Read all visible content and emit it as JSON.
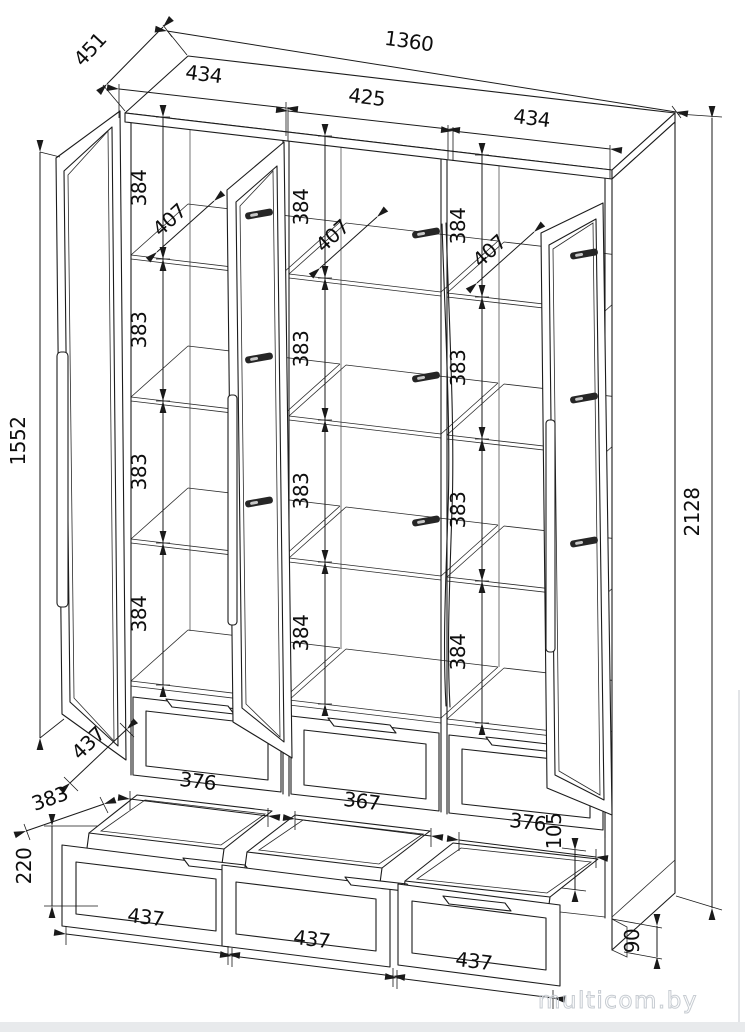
{
  "watermark": "multicom.by",
  "dims": {
    "top_width": "1360",
    "top_depth": "451",
    "section_widths": [
      "434",
      "425",
      "434"
    ],
    "shelf_gaps_left": [
      "384",
      "383",
      "383",
      "384"
    ],
    "shelf_gaps_middle": [
      "384",
      "383",
      "383",
      "384"
    ],
    "shelf_gaps_right": [
      "384",
      "383",
      "383",
      "384"
    ],
    "shelf_depth_left": "407",
    "shelf_depth_middle": "407",
    "shelf_depth_right": "407",
    "door_height": "1552",
    "total_height": "2128",
    "door_width": "437",
    "drawer_box_depth": "383",
    "drawer_front_height": "220",
    "drawer_box_widths": [
      "376",
      "367",
      "376"
    ],
    "drawer_box_height": "105",
    "drawer_front_widths": [
      "437",
      "437",
      "437"
    ],
    "plinth_height": "90"
  }
}
